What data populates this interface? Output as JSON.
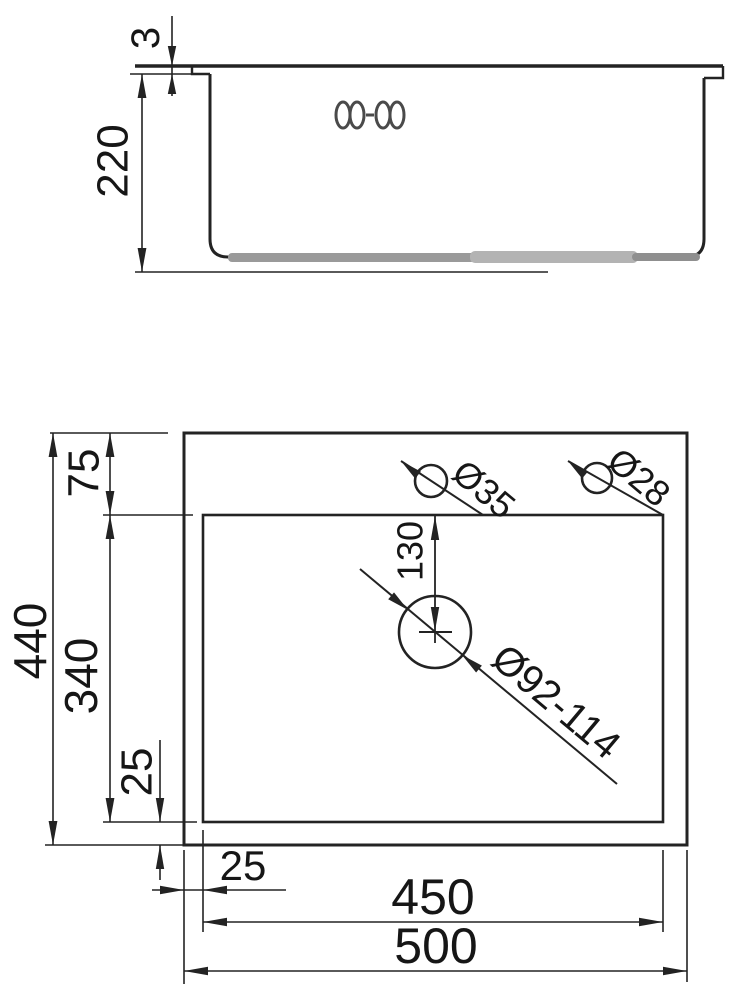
{
  "drawing": {
    "title": "kitchen-sink-dimension-drawing",
    "line_color": "#232323",
    "background": "#ffffff",
    "side_view": {
      "rim_thickness_mm": "3",
      "bowl_depth_mm": "220"
    },
    "plan_view": {
      "overall_width_mm": "440",
      "overall_length_mm": "500",
      "bowl_width_mm": "340",
      "bowl_length_mm": "450",
      "rim_top_offset_mm": "75",
      "rim_bottom_offset_mm": "25",
      "rim_left_offset_mm": "25",
      "drain_offset_from_top_mm": "130",
      "faucet_hole_diameter": "Ø35",
      "accessory_hole_diameter": "Ø28",
      "drain_hole_diameter": "Ø92-114"
    }
  }
}
